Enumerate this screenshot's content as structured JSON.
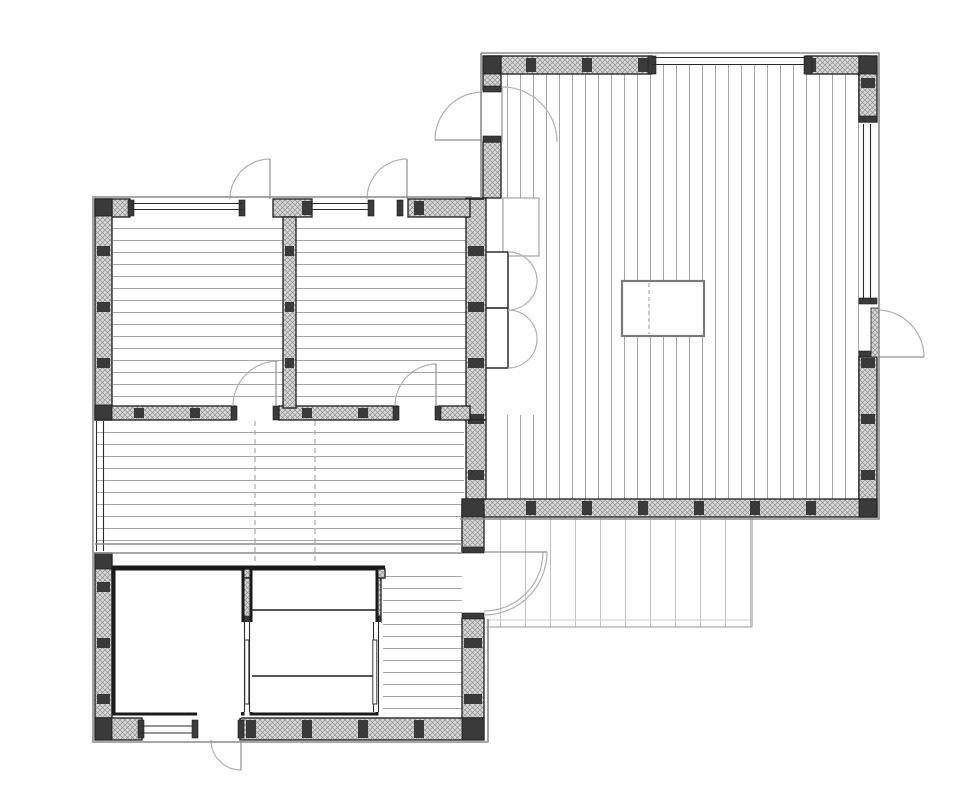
{
  "figure": {
    "kind": "architectural-floor-plan",
    "text_labels": [],
    "rooms_depicted": [
      "living-room",
      "bedroom-1",
      "bedroom-2",
      "hallway",
      "entry-corridor",
      "bathroom",
      "sauna",
      "deck"
    ],
    "features": [
      "hatched-insulated-exterior-walls",
      "wall-studs",
      "plank-floor-boards",
      "door-swing-arcs",
      "window-glazing-lines",
      "kitchen-island",
      "wardrobe-with-folding-doors",
      "sauna-benches"
    ]
  },
  "canvas": {
    "width": 960,
    "height": 800,
    "background": "#ffffff"
  },
  "colors": {
    "white": "#ffffff",
    "wall_line": "#1c1c1c",
    "wall_hatch_bg": "#d8d8d8",
    "wall_hatch_line": "#8f8f8f",
    "stud": "#2e2e2e",
    "jamb": "#3a3a3a",
    "outer_offset_line": "#8c8c8c",
    "plank_line": "#a6a6a6",
    "deck_line": "#c2c2c2",
    "deck_edge": "#999999",
    "arc": "#b0b0b0",
    "leaf": "#8f8f8f",
    "glazing": "#2a2a2a",
    "dashed_line": "#9a9a9a",
    "island_border": "#7a7a7a",
    "island_dash": "#cccccc",
    "counter_border": "#aaaaaa",
    "wet_wall": "#1a1a1a",
    "bench_line": "#1f1f1f"
  },
  "patterns": {
    "living_room_plank_spacing_px": 13,
    "bedroom_plank_spacing_px": 12,
    "deck_plank_spacing_px": 25,
    "stud_interval_px": 56,
    "hatch_cell_px": 5
  }
}
